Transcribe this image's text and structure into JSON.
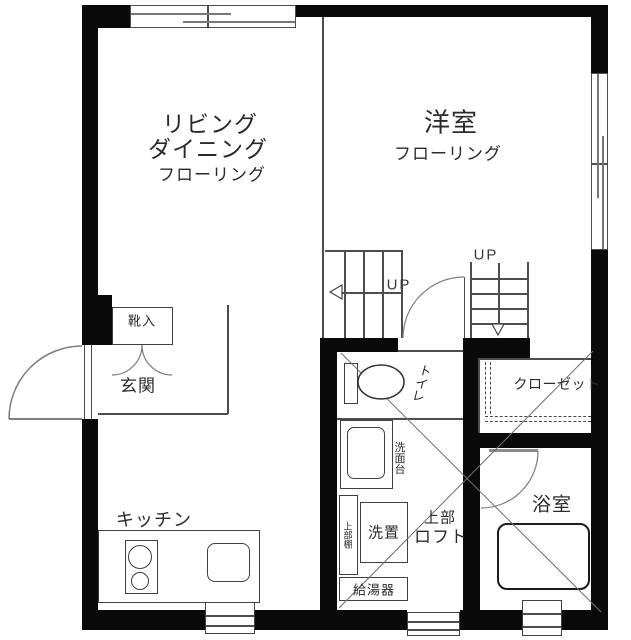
{
  "colors": {
    "wall": "#0a0a0a",
    "thin_line": "#4d4d4d",
    "door_arc": "#777777",
    "text": "#2b2b2b",
    "background": "#ffffff"
  },
  "rooms": {
    "living_dining": {
      "line1": "リビング",
      "line2": "ダイニング",
      "floor": "フローリング"
    },
    "western_room": {
      "name": "洋室",
      "floor": "フローリング"
    },
    "entrance": {
      "name": "玄関"
    },
    "shoe_cabinet": {
      "name": "靴入"
    },
    "kitchen": {
      "name": "キッチン"
    },
    "toilet": {
      "name": "トイレ"
    },
    "washstand": {
      "name": "洗面台"
    },
    "upper_shelf": {
      "name": "上部棚"
    },
    "washer_space": {
      "name": "洗置"
    },
    "water_heater": {
      "name": "給湯器"
    },
    "upper_loft": {
      "line1": "上部",
      "line2": "ロフト"
    },
    "closet": {
      "name": "クローゼット"
    },
    "bathroom": {
      "name": "浴室"
    }
  },
  "stairs": {
    "up_left": "UP",
    "up_right": "UP"
  }
}
